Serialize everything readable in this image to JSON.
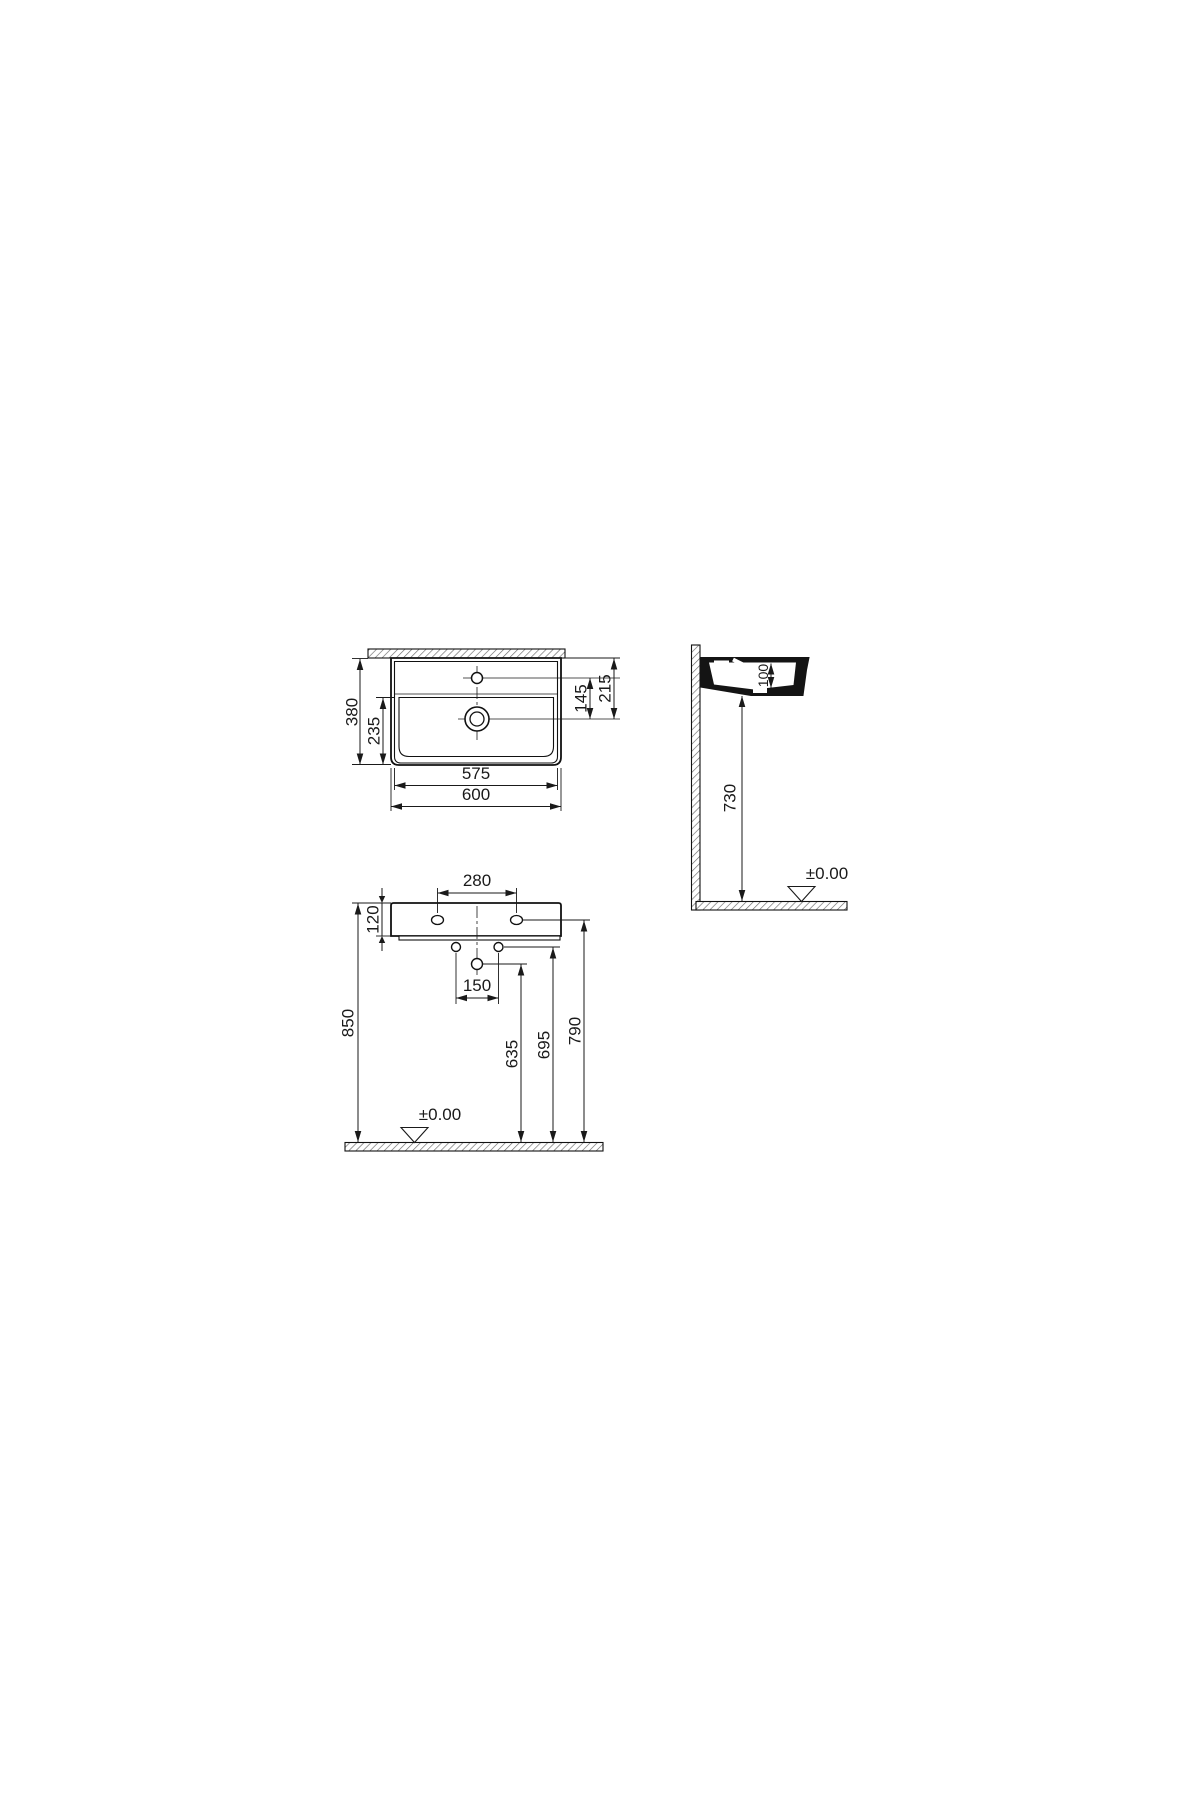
{
  "drawing": {
    "kind": "washbasin installation technical drawing",
    "line_color": "#1a1a1a",
    "plan_view": {
      "overall_depth": "380",
      "bowl_depth": "235",
      "tap_to_drain": "145",
      "rear_to_drain": "215",
      "bowl_width": "575",
      "overall_width": "600"
    },
    "side_view": {
      "basin_inner_depth": "100",
      "underside_height": "730",
      "floor_datum": "±0.00"
    },
    "front_view": {
      "tap_hole_spacing": "280",
      "apron_height": "120",
      "supply_spacing": "150",
      "rim_height": "850",
      "waste_height": "635",
      "supply_height": "695",
      "fixing_hole_height": "790",
      "floor_datum": "±0.00"
    }
  }
}
